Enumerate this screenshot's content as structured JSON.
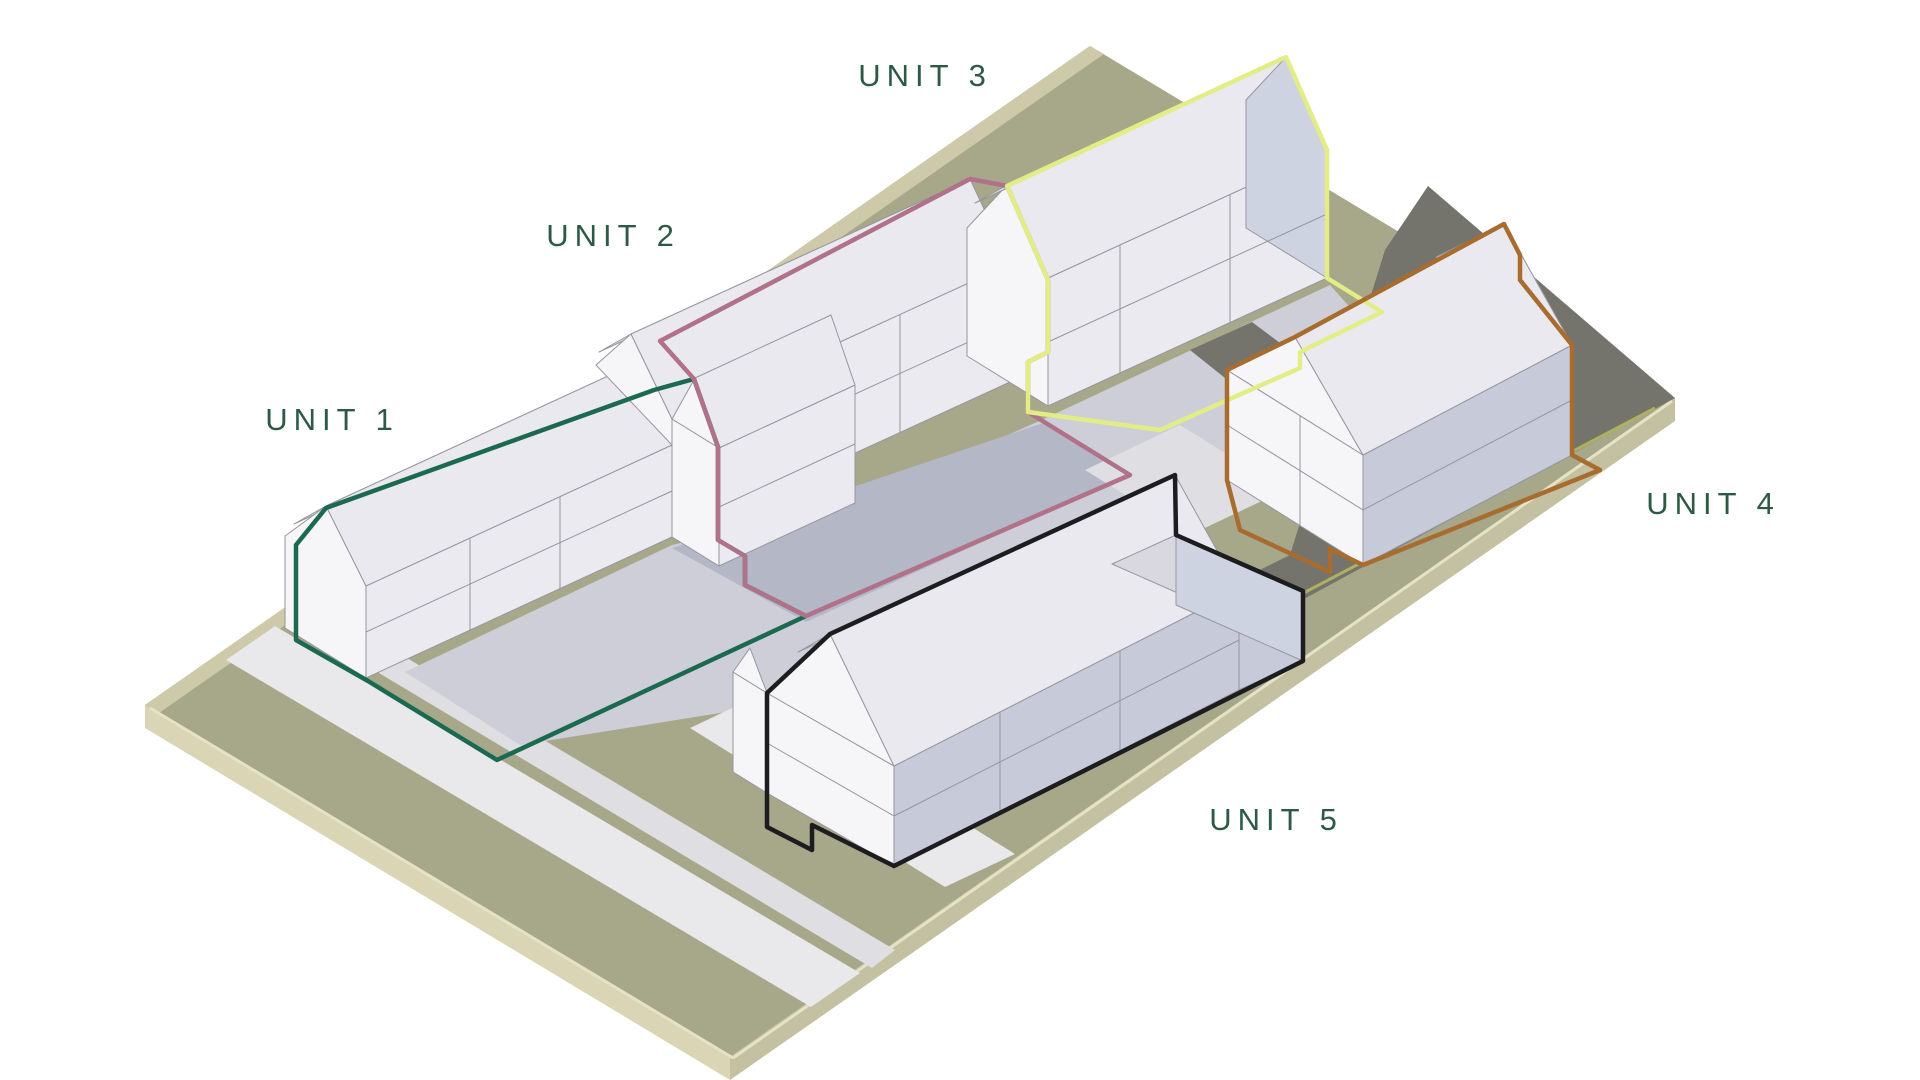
{
  "diagram": {
    "type": "axonometric-site-plan",
    "units": [
      {
        "id": "unit-1",
        "label": "UNIT 1",
        "outline_color": "#1b6a50"
      },
      {
        "id": "unit-2",
        "label": "UNIT 2",
        "outline_color": "#b07189"
      },
      {
        "id": "unit-3",
        "label": "UNIT 3",
        "outline_color": "#e3ed85"
      },
      {
        "id": "unit-4",
        "label": "UNIT 4",
        "outline_color": "#a86c2e"
      },
      {
        "id": "unit-5",
        "label": "UNIT 5",
        "outline_color": "#1d1d20"
      }
    ],
    "label_color": "#2d5a47",
    "palette": {
      "background": "#ffffff",
      "lawn": "#a7a78a",
      "site_edge_sw": "#d9d5b5",
      "site_edge_se": "#c4c0a2",
      "curb": "#cdc9a9",
      "curb_line": "#e6e2c6",
      "path_light": "#e9e8ea",
      "path_soft": "#dfdee3",
      "court": "#cdced8",
      "court_shadow": "#b4b7c6",
      "road": "#74746c",
      "road_line": "#b0b060",
      "wall_lit": "#f6f5f7",
      "wall_front": "#ebeaf0",
      "wall_shaded": "#c6cad9",
      "roof_se": "#eae9ef",
      "roof_nw": "#d9d8e1",
      "gable_shaded": "#ced3e2",
      "edge_line": "#97969e"
    }
  }
}
